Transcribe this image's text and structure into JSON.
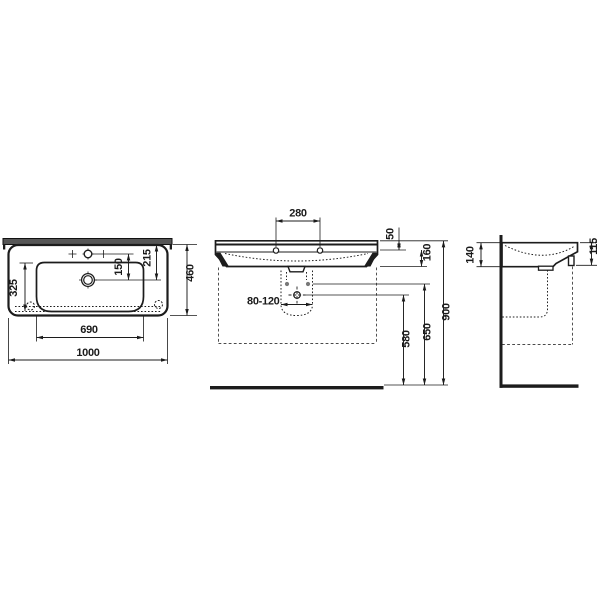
{
  "drawing": {
    "type": "washbasin-technical-drawing",
    "views": {
      "top": "plan view",
      "front": "front elevation",
      "side": "side elevation"
    },
    "line_colors": {
      "ink": "#1c1c1c",
      "wall_band": "#565656",
      "clearance_dash": "#4a4a4a"
    }
  },
  "dims": {
    "overall_width": "1000",
    "bowl_width": "690",
    "overall_depth": "460",
    "bowl_depth": "325",
    "tap_to_drain": "150",
    "drain_from_rear": "215",
    "hole_spacing": "280",
    "top_to_holes": "50",
    "holes_to_skirt": "160",
    "drain_pipe_range": "80-120",
    "drain_height": "580",
    "fixing_height": "650",
    "rim_height": "900",
    "rear_edge_height": "140",
    "front_edge_height": "115"
  }
}
